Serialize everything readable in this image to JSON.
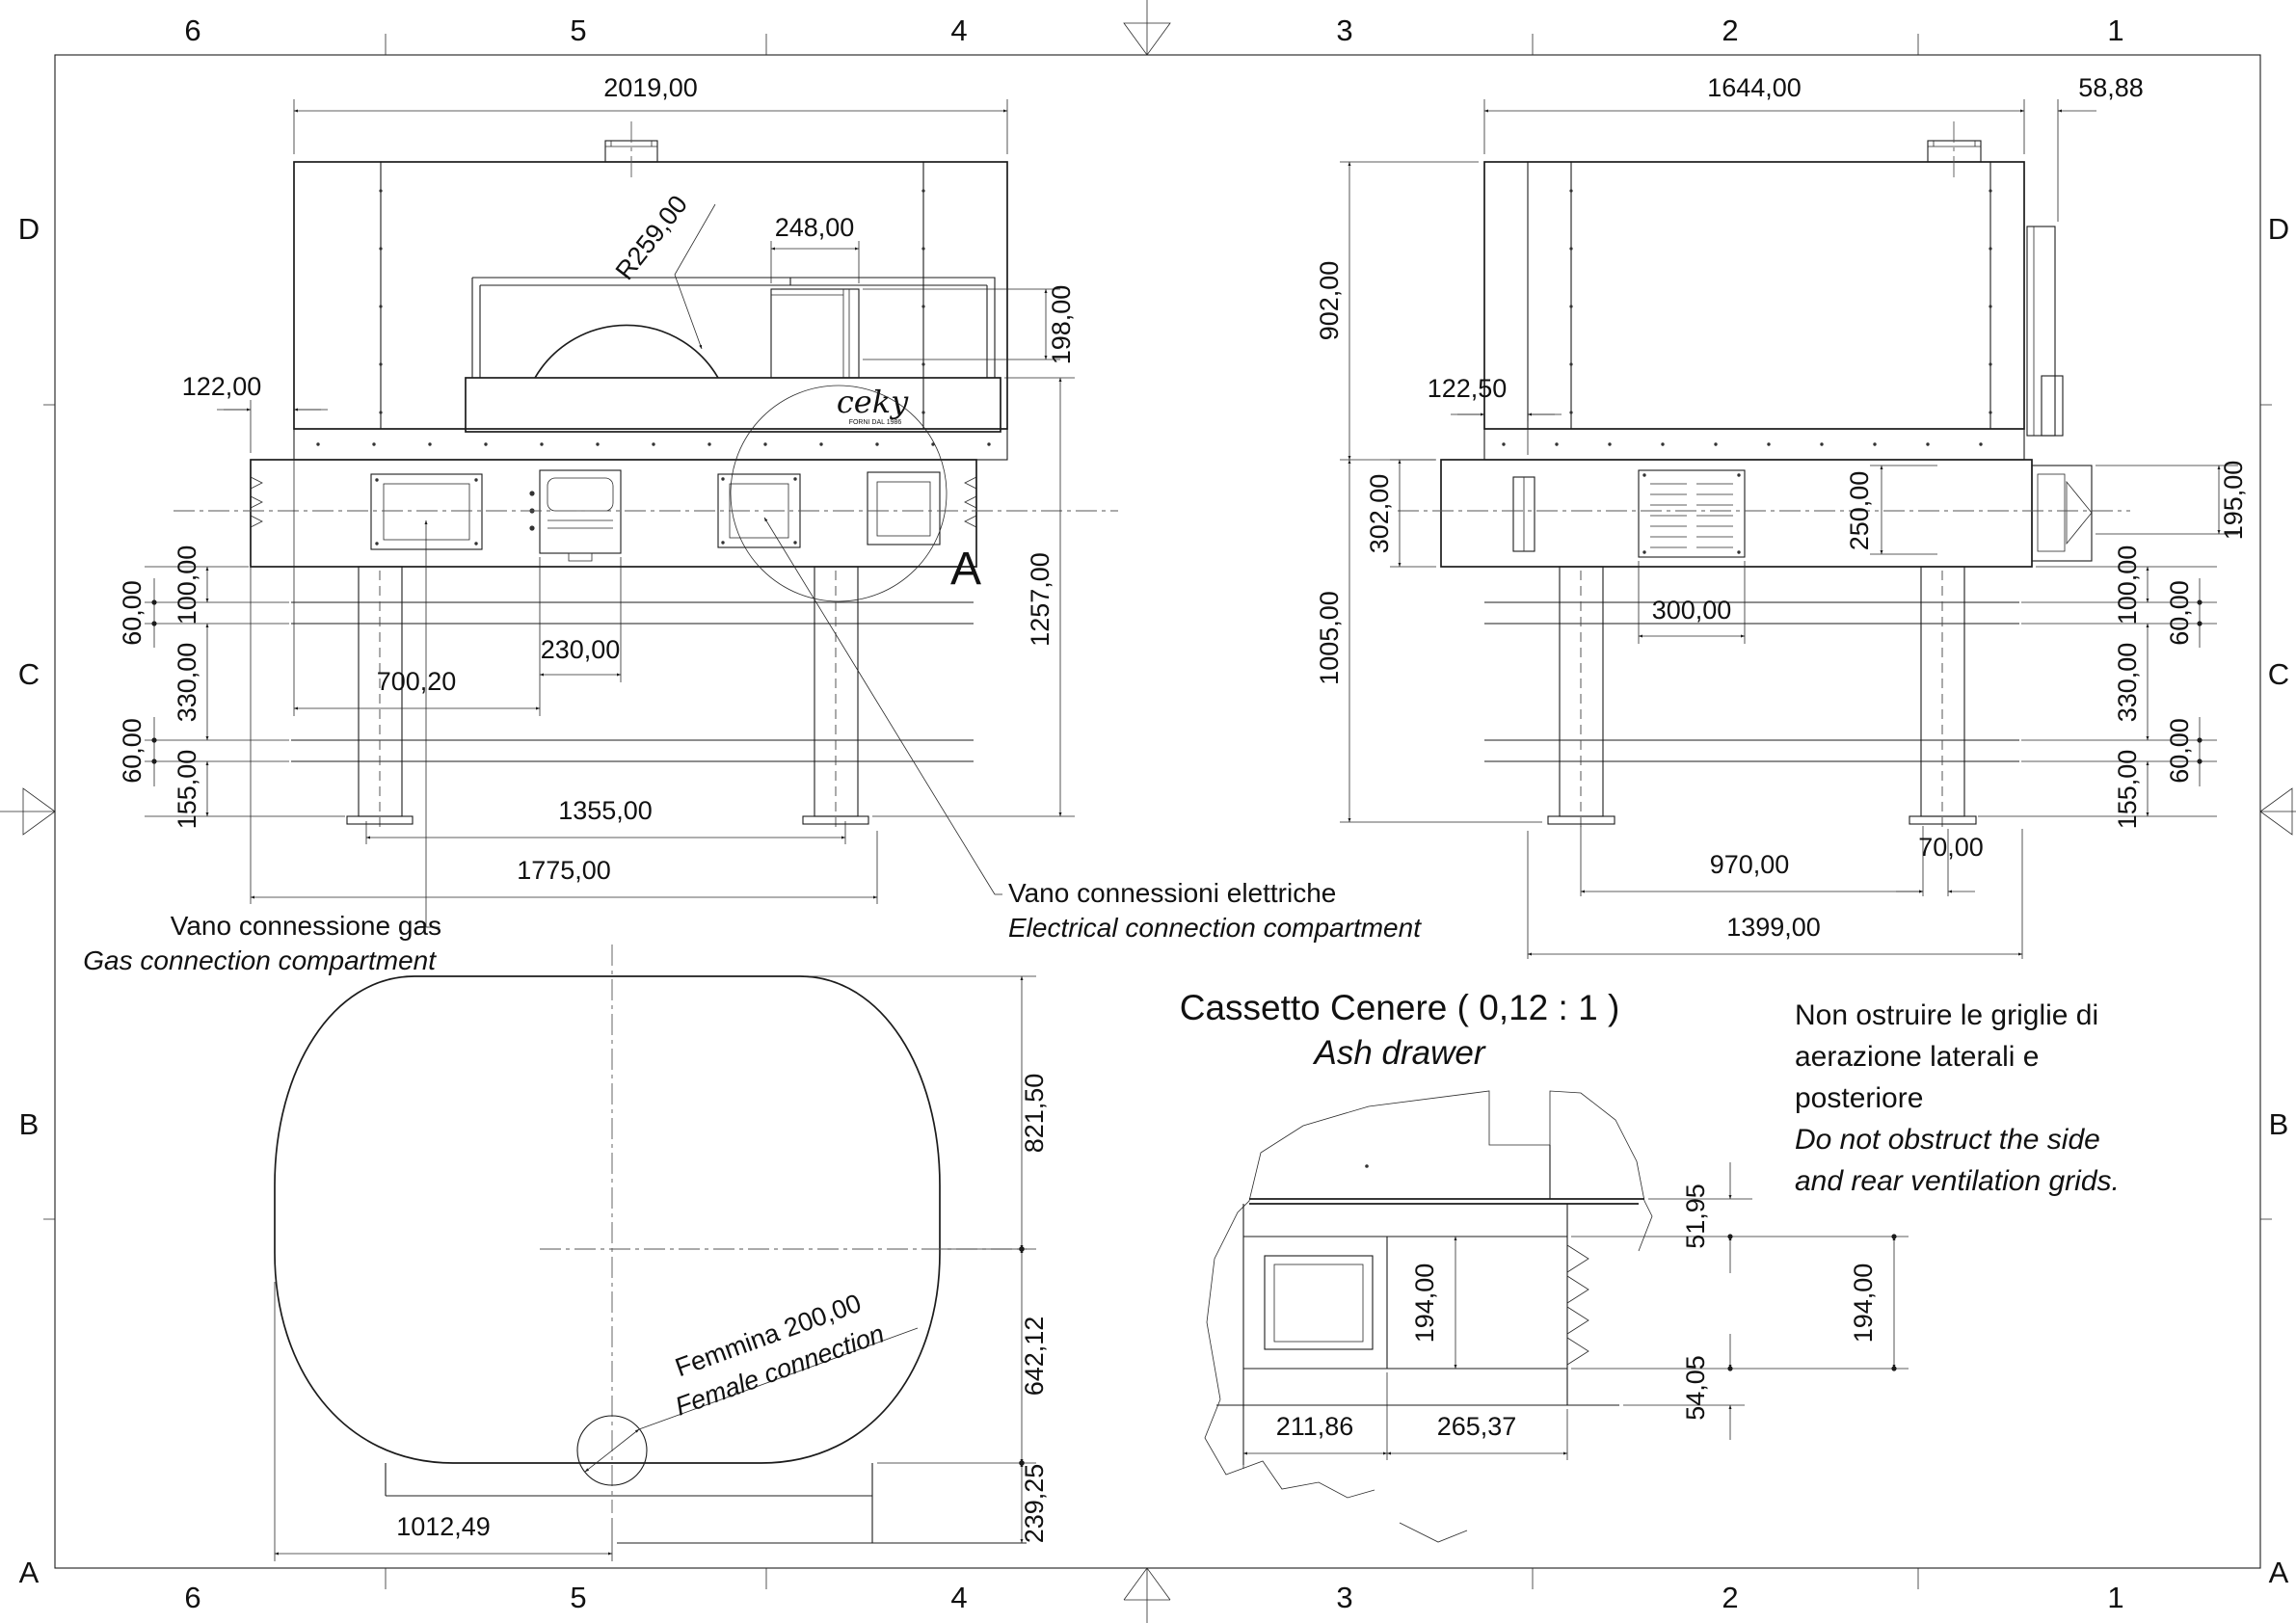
{
  "sheet": {
    "background": "#ffffff",
    "line_color": "#1c1c1c"
  },
  "border": {
    "cols": [
      "6",
      "5",
      "4",
      "3",
      "2",
      "1"
    ],
    "rows": [
      "D",
      "C",
      "B",
      "A"
    ]
  },
  "logo": {
    "name": "ceky",
    "sub": "FORNI DAL 1986"
  },
  "front_view": {
    "dims": {
      "width": "2019,00",
      "radius": "R259,00",
      "opening_w": "248,00",
      "opening_h": "198,00",
      "offset": "122,00",
      "height": "1257,00",
      "s100": "100,00",
      "s60a": "60,00",
      "s330": "330,00",
      "s60b": "60,00",
      "s155": "155,00",
      "drawer_w": "230,00",
      "gas_x": "700,20",
      "legs_span": "1355,00",
      "base_w": "1775,00"
    },
    "detail_marker": "A",
    "labels": {
      "gas_it": "Vano connessione gas",
      "gas_en": "Gas connection compartment",
      "elec_it": "Vano connessioni elettriche",
      "elec_en": "Electrical connection compartment"
    }
  },
  "side_view": {
    "dims": {
      "depth": "1644,00",
      "overhang": "58,88",
      "body_h": "902,00",
      "offset": "122,50",
      "band_h": "302,00",
      "under_h": "1005,00",
      "grille_h": "250,00",
      "handle_h": "195,00",
      "grille_w": "300,00",
      "s100": "100,00",
      "s60a": "60,00",
      "s330": "330,00",
      "s60b": "60,00",
      "s155": "155,00",
      "legs_span": "970,00",
      "foot": "70,00",
      "base_d": "1399,00"
    }
  },
  "plan_view": {
    "dims": {
      "front_half": "821,50",
      "rear_half": "642,12",
      "tail": "239,25",
      "cx": "1012,49"
    },
    "labels": {
      "female_it": "Femmina 200,00",
      "female_en": "Female connection"
    }
  },
  "detail_view": {
    "title": "Cassetto Cenere ( 0,12 : 1 )",
    "subtitle": "Ash drawer",
    "dims": {
      "top_gap": "51,95",
      "h1": "194,00",
      "h2": "194,00",
      "bottom_gap": "54,05",
      "w1": "211,86",
      "w2": "265,37"
    }
  },
  "note": {
    "lines_it": [
      "Non ostruire le griglie di",
      "aerazione laterali e",
      "posteriore"
    ],
    "lines_en": [
      "Do not obstruct the side",
      "and rear ventilation grids."
    ]
  }
}
